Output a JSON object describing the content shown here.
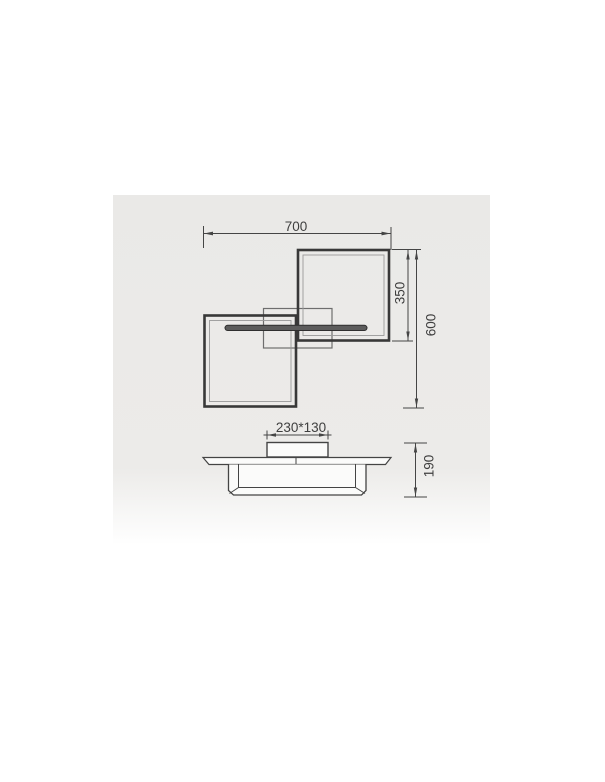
{
  "drawing": {
    "type": "technical-dimension-diagram",
    "views": {
      "top_view": "two overlapping square frames with crossing light bar and mounting canopy",
      "side_view": "flat plate with canopy on top and square frame profile below"
    },
    "labels": {
      "overall_width": "700",
      "upper_square_height": "350",
      "overall_height": "600",
      "canopy_size": "230*130",
      "fixture_height": "190"
    },
    "colors": {
      "background": "#ffffff",
      "panel": "#ecebe9",
      "dimension_line": "#454545",
      "thick_frame": "#383838",
      "thin_frame": "#6e6e6e",
      "bar_fill": "#5c5c5c",
      "side_fill": "#fbfbfa",
      "text": "#3f3f3f"
    }
  }
}
